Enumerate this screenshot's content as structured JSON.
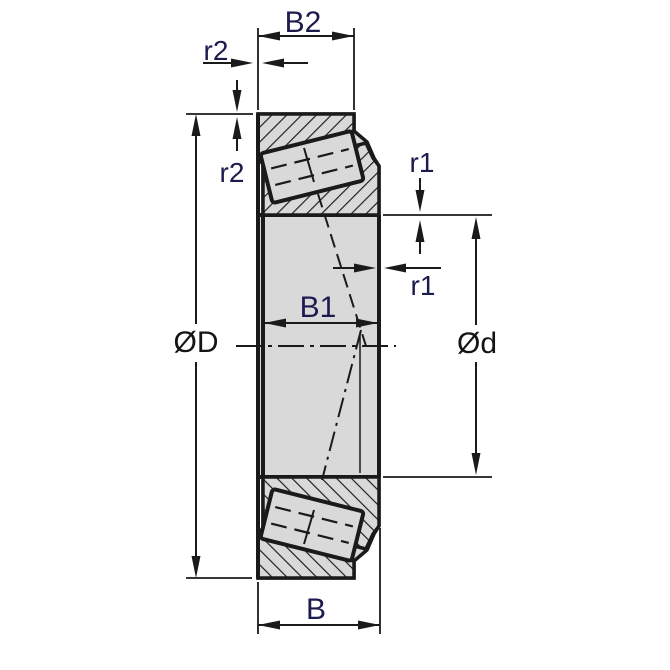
{
  "dimensions": {
    "b2": {
      "label": "B2"
    },
    "r2_top": {
      "label": "r2"
    },
    "r2_left": {
      "label": "r2"
    },
    "r1_top": {
      "label": "r1"
    },
    "r1_right": {
      "label": "r1"
    },
    "outer_diameter": {
      "label": "ØD"
    },
    "bore_diameter": {
      "label": "Ød"
    },
    "b1": {
      "label": "B1"
    },
    "b": {
      "label": "B"
    }
  },
  "colors": {
    "line": "#1a1a1a",
    "part_fill": "#d9d9d9",
    "background": "#ffffff",
    "label_navy": "#1b1b4e",
    "label_black": "#141414"
  }
}
